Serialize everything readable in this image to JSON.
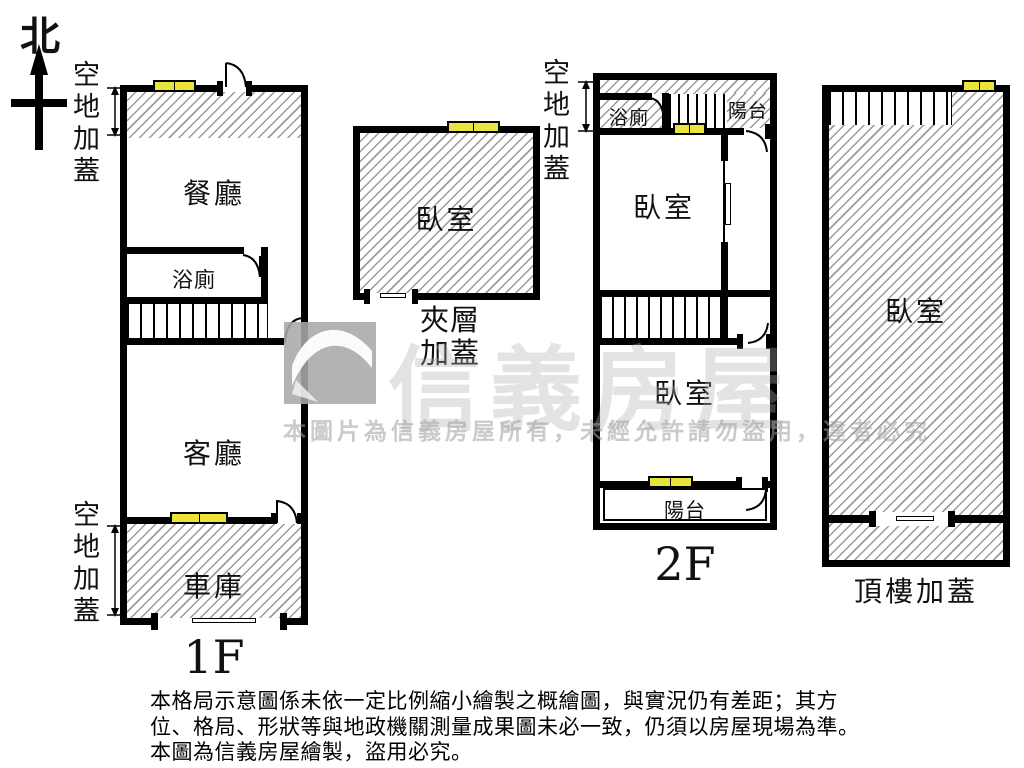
{
  "compass": {
    "north": "北"
  },
  "plans": {
    "f1": {
      "label": "1F",
      "annotation_top": "空地加蓋",
      "annotation_bottom": "空地加蓋",
      "rooms": {
        "dining": "餐廳",
        "bath": "浴廁",
        "living": "客廳",
        "garage": "車庫"
      }
    },
    "mezzanine": {
      "label": "夾層加蓋",
      "rooms": {
        "bedroom": "臥室"
      }
    },
    "f2": {
      "label": "2F",
      "annotation_top": "空地加蓋",
      "rooms": {
        "bath": "浴廁",
        "balcony_top": "陽台",
        "bedroom_front": "臥室",
        "bedroom_back": "臥室",
        "balcony_bottom": "陽台"
      }
    },
    "rooftop": {
      "label": "頂樓加蓋",
      "rooms": {
        "bedroom": "臥室"
      }
    }
  },
  "watermark": {
    "brand": "信義房屋",
    "notice": "本圖片為信義房屋所有，未經允許請勿盜用，違者必究"
  },
  "disclaimer": {
    "line1": "本格局示意圖係未依一定比例縮小繪製之概繪圖，與實況仍有差距；其方",
    "line2": "位、格局、形狀等與地政機關測量成果圖未必一致，仍須以房屋現場為準。",
    "line3": "本圖為信義房屋繪製，盜用必究。"
  },
  "colors": {
    "window_yellow": "#e9e43b",
    "wall": "#000000"
  }
}
